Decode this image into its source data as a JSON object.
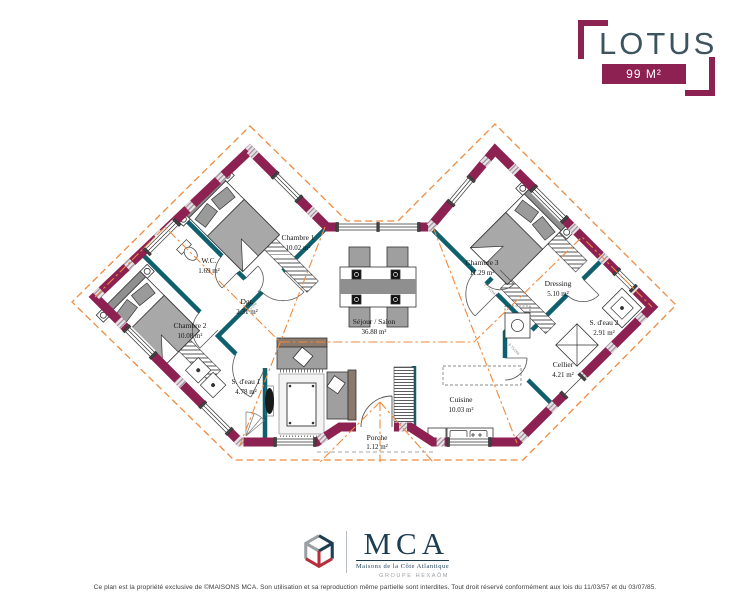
{
  "header": {
    "title": "LOTUS",
    "area_badge": "99 M²"
  },
  "plan": {
    "door_label": "P 75/204",
    "rooms": [
      {
        "id": "chambre-1",
        "label": "Chambre 1",
        "area": "10.02 m²"
      },
      {
        "id": "wc",
        "label": "W.C.",
        "area": "1.69 m²"
      },
      {
        "id": "degagement",
        "label": "Dgt.",
        "area": "2.31 m²"
      },
      {
        "id": "chambre-2",
        "label": "Chambre 2",
        "area": "10.08 m²"
      },
      {
        "id": "salle-eau-1",
        "label": "S. d'eau 1",
        "area": "4.78 m²"
      },
      {
        "id": "sejour-salon",
        "label": "Séjour / Salon",
        "area": "36.88 m²"
      },
      {
        "id": "chambre-3",
        "label": "Chambre 3",
        "area": "11.29 m²"
      },
      {
        "id": "dressing",
        "label": "Dressing",
        "area": "5.10 m²"
      },
      {
        "id": "salle-eau-2",
        "label": "S. d'eau 2",
        "area": "2.91 m²"
      },
      {
        "id": "cellier",
        "label": "Cellier",
        "area": "4.21 m²"
      },
      {
        "id": "cuisine",
        "label": "Cuisine",
        "area": "10.03 m²"
      },
      {
        "id": "porche",
        "label": "Porche",
        "area": "1.12 m²"
      }
    ],
    "colors": {
      "exterior_wall": "#8d2152",
      "interior_wall": "#0f606e",
      "roof_lines": "#ee8a3e",
      "brand_accent": "#8d2152",
      "brand_title": "#3c545e",
      "mca_navy": "#1d3d52"
    }
  },
  "footer": {
    "brand": "MCA",
    "brand_tagline": "Maisons de la Côte Atlantique",
    "brand_group": "GROUPE HEXAÔM",
    "copyright": "Ce plan est la propriété exclusive de ©MAISONS MCA. Son utilisation et sa reproduction même partielle sont interdites. Tout droit réservé conformément aux lois du 11/03/57 et du 03/07/85."
  }
}
